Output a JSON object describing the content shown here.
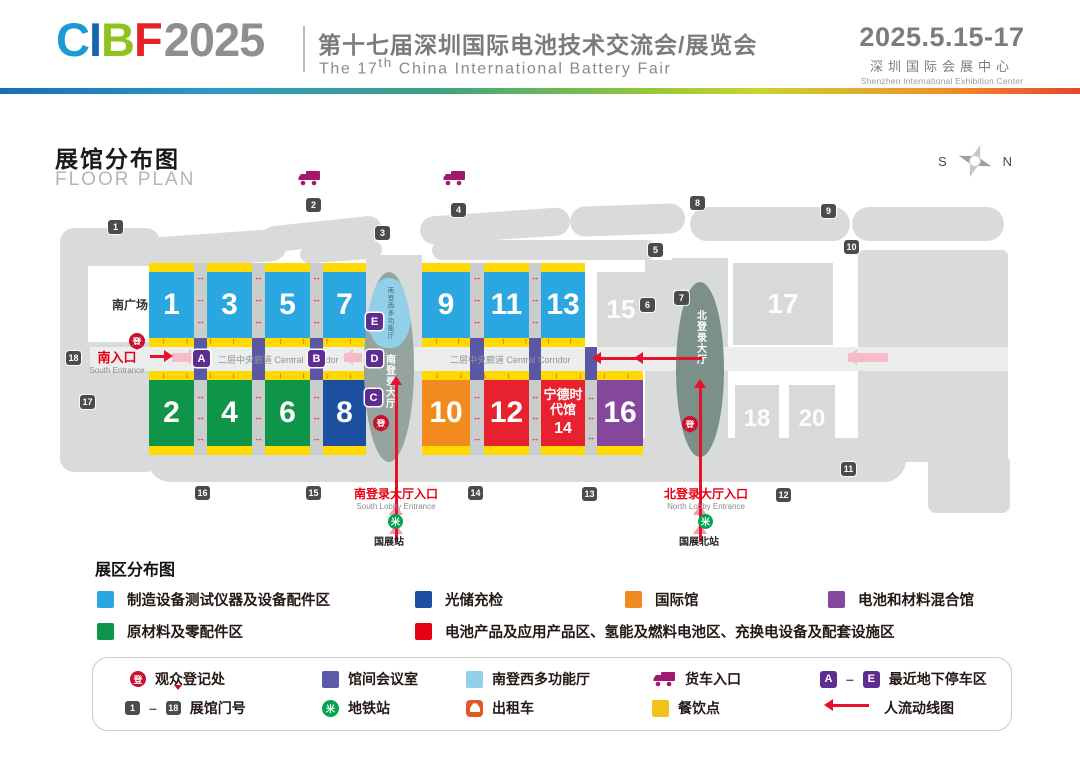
{
  "header": {
    "logo_c": "C",
    "logo_i": "I",
    "logo_b": "B",
    "logo_f": "F",
    "logo_year": "2025",
    "title_cn": "第十七届深圳国际电池技术交流会/展览会",
    "title_en_pre": "The 17",
    "title_en_sup": "th",
    "title_en_post": " China International Battery Fair",
    "dates": "2025.5.15-17",
    "venue_cn": "深圳国际会展中心",
    "venue_en": "Shenzhen International Exhibition Center"
  },
  "map": {
    "title_cn": "展馆分布图",
    "title_en": "FLOOR PLAN",
    "compass_s": "S",
    "compass_n": "N",
    "south_plaza": "南广场",
    "south_entrance_cn": "南入口",
    "south_entrance_en": "South Entrance",
    "corridor": "二层中央廊道 Central Corridor",
    "south_lobby": "南登录大厅",
    "multifunc": "南登西多功能厅",
    "north_lobby": "北登录大厅",
    "reg": "登",
    "south_lobby_entrance_cn": "南登录大厅入口",
    "south_lobby_entrance_en": "South Lobby Entrance",
    "north_lobby_entrance_cn": "北登录大厅入口",
    "north_lobby_entrance_en": "North Lobby Entrance",
    "metro_south": "国展站",
    "metro_north": "国展北站",
    "halls": {
      "h1": "1",
      "h2": "2",
      "h3": "3",
      "h4": "4",
      "h5": "5",
      "h6": "6",
      "h7": "7",
      "h8": "8",
      "h9": "9",
      "h10": "10",
      "h11": "11",
      "h12": "12",
      "h13": "13",
      "h15": "15",
      "h16": "16",
      "h17": "17",
      "h18": "18",
      "h20": "20"
    },
    "hall14": {
      "line1": "宁德时代馆",
      "line2": "14"
    },
    "parking": {
      "a": "A",
      "b": "B",
      "c": "C",
      "d": "D",
      "e": "E"
    },
    "gates": [
      "1",
      "2",
      "3",
      "4",
      "5",
      "6",
      "7",
      "8",
      "9",
      "10",
      "11",
      "12",
      "13",
      "14",
      "15",
      "16",
      "17",
      "18"
    ]
  },
  "icons": {
    "metro_glyph": "米"
  },
  "colors": {
    "hall_blue": "#2aa7e1",
    "hall_green": "#0f9549",
    "hall_dark_blue": "#1c4f9f",
    "hall_orange": "#f28a1d",
    "hall_red": "#e7212e",
    "hall_purple": "#84479c",
    "strip_yellow": "#ffd900",
    "meeting_indigo": "#5c59a7",
    "multifunc_blue": "#92cfe8",
    "route_red": "#e8112d",
    "reg_red": "#c8102e",
    "metro_green": "#00a551",
    "truck_magenta": "#a1196d",
    "taxi_orange": "#e0572a",
    "parking_purple": "#5f2c91",
    "food_yellow": "#efc51d"
  },
  "legend": {
    "title": "展区分布图",
    "item_equipment": "制造设备测试仪器及设备配件区",
    "item_storage": "光储充检",
    "item_international": "国际馆",
    "item_mixed": "电池和材料混合馆",
    "item_materials": "原材料及零配件区",
    "item_battery": "电池产品及应用产品区、氢能及燃料电池区、充换电设备及配套设施区"
  },
  "footer": {
    "reg_label": "观众登记处",
    "meeting_label": "馆间会议室",
    "multifunc_label": "南登西多功能厅",
    "truck_label": "货车入口",
    "parking_a": "A",
    "parking_e": "E",
    "parking_label": "最近地下停车区",
    "gate_1": "1",
    "gate_18": "18",
    "gate_label": "展馆门号",
    "metro_label": "地铁站",
    "taxi_label": "出租车",
    "food_label": "餐饮点",
    "flow_label": "人流动线图",
    "dash": "–"
  }
}
